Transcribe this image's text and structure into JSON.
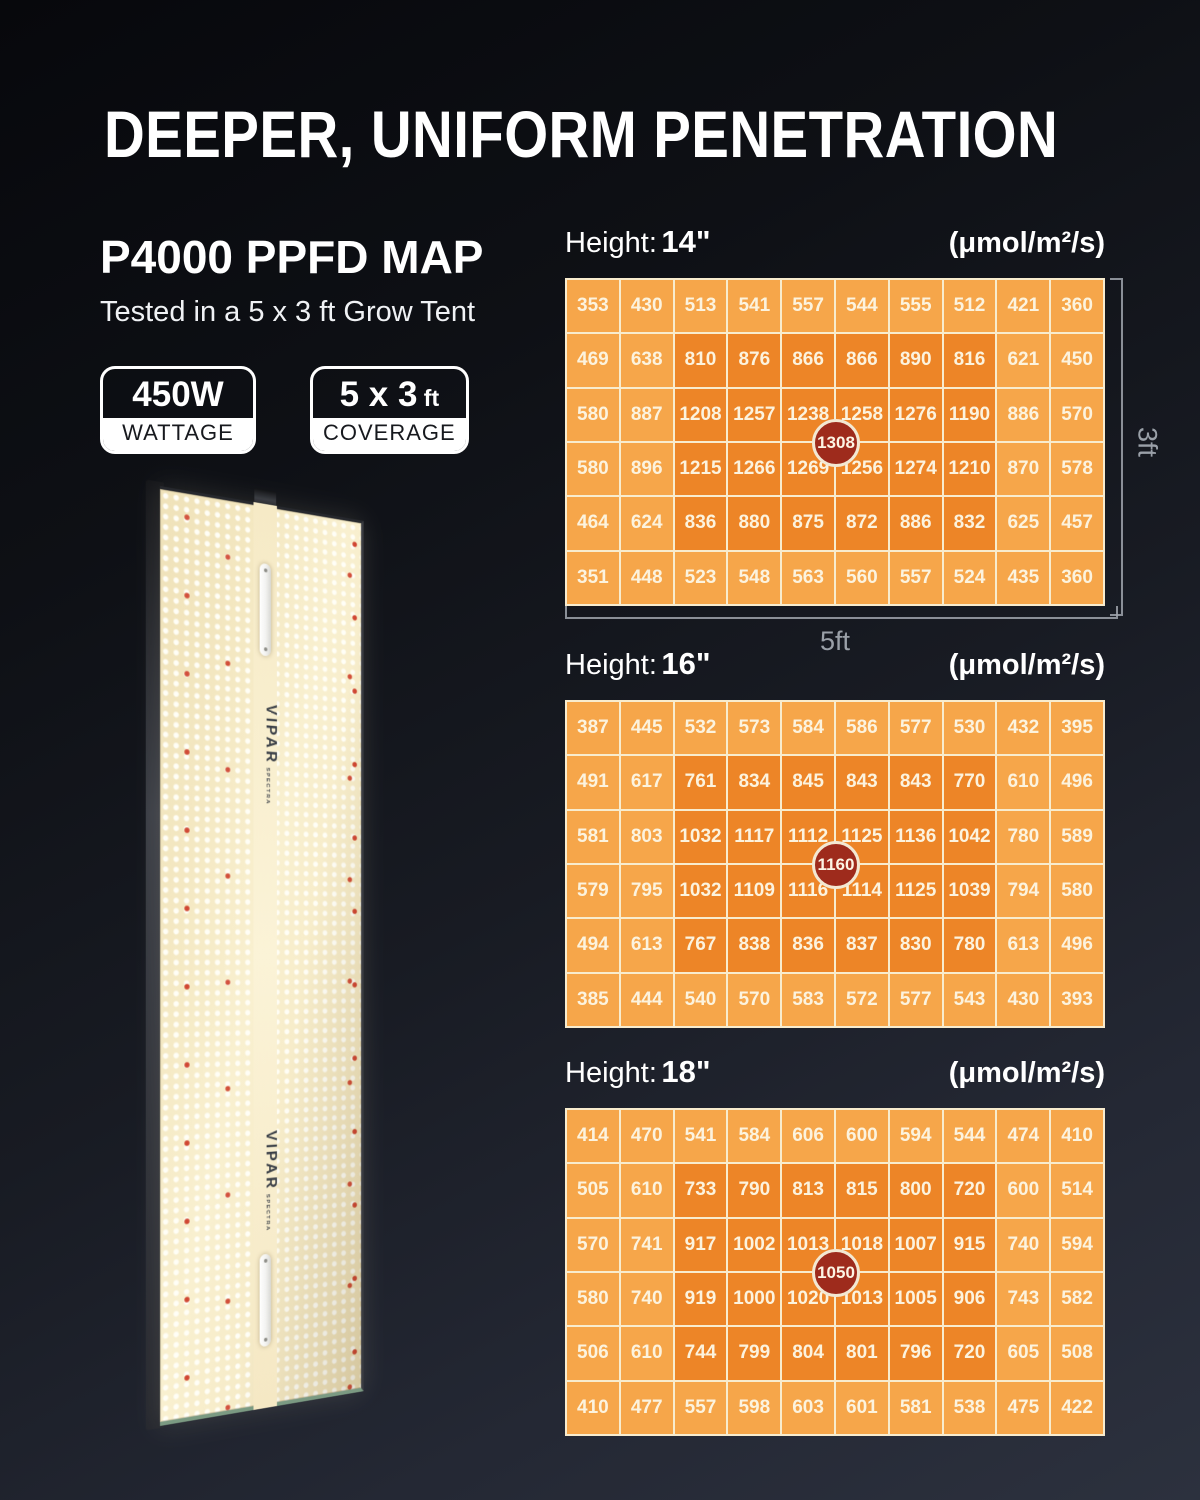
{
  "title": "DEEPER, UNIFORM PENETRATION",
  "intro": {
    "heading": "P4000 PPFD MAP",
    "caption": "Tested in a 5 x 3 ft Grow Tent"
  },
  "badges": [
    {
      "value": "450W",
      "suffix": "",
      "label": "WATTAGE"
    },
    {
      "value": "5 x 3",
      "suffix": " ft",
      "label": "COVERAGE"
    }
  ],
  "panel": {
    "brand": "VIPAR",
    "brand_sub": "SPECTRA"
  },
  "dimensions": {
    "width_label": "5ft",
    "height_label": "3ft"
  },
  "colors": {
    "cell_low": "#f6a64a",
    "cell_high": "#ed8527",
    "peak_bg": "#9e2b1c",
    "grid_line": "#f8ecce",
    "background_top": "#07080c",
    "background_bottom": "#2c313e"
  },
  "chart_data": [
    {
      "type": "heatmap",
      "height_label": "Height:",
      "height_value": "14\"",
      "units": "(μmol/m²/s)",
      "peak_center": 1308,
      "x_extent_label": "5ft",
      "y_extent_label": "3ft",
      "grid": "10 columns x 6 rows",
      "high_zone": "rows 2-5, cols 3-8",
      "rows": [
        [
          353,
          430,
          513,
          541,
          557,
          544,
          555,
          512,
          421,
          360
        ],
        [
          469,
          638,
          810,
          876,
          866,
          866,
          890,
          816,
          621,
          450
        ],
        [
          580,
          887,
          1208,
          1257,
          1238,
          1258,
          1276,
          1190,
          886,
          570
        ],
        [
          580,
          896,
          1215,
          1266,
          1269,
          1256,
          1274,
          1210,
          870,
          578
        ],
        [
          464,
          624,
          836,
          880,
          875,
          872,
          886,
          832,
          625,
          457
        ],
        [
          351,
          448,
          523,
          548,
          563,
          560,
          557,
          524,
          435,
          360
        ]
      ]
    },
    {
      "type": "heatmap",
      "height_label": "Height:",
      "height_value": "16\"",
      "units": "(μmol/m²/s)",
      "peak_center": 1160,
      "grid": "10 columns x 6 rows",
      "high_zone": "rows 2-5, cols 3-8",
      "rows": [
        [
          387,
          445,
          532,
          573,
          584,
          586,
          577,
          530,
          432,
          395
        ],
        [
          491,
          617,
          761,
          834,
          845,
          843,
          843,
          770,
          610,
          496
        ],
        [
          581,
          803,
          1032,
          1117,
          1112,
          1125,
          1136,
          1042,
          780,
          589
        ],
        [
          579,
          795,
          1032,
          1109,
          1116,
          1114,
          1125,
          1039,
          794,
          580
        ],
        [
          494,
          613,
          767,
          838,
          836,
          837,
          830,
          780,
          613,
          496
        ],
        [
          385,
          444,
          540,
          570,
          583,
          572,
          577,
          543,
          430,
          393
        ]
      ]
    },
    {
      "type": "heatmap",
      "height_label": "Height:",
      "height_value": "18\"",
      "units": "(μmol/m²/s)",
      "peak_center": 1050,
      "grid": "10 columns x 6 rows",
      "high_zone": "rows 2-5, cols 3-8",
      "rows": [
        [
          414,
          470,
          541,
          584,
          606,
          600,
          594,
          544,
          474,
          410
        ],
        [
          505,
          610,
          733,
          790,
          813,
          815,
          800,
          720,
          600,
          514
        ],
        [
          570,
          741,
          917,
          1002,
          1013,
          1018,
          1007,
          915,
          740,
          594
        ],
        [
          580,
          740,
          919,
          1000,
          1020,
          1013,
          1005,
          906,
          743,
          582
        ],
        [
          506,
          610,
          744,
          799,
          804,
          801,
          796,
          720,
          605,
          508
        ],
        [
          410,
          477,
          557,
          598,
          603,
          601,
          581,
          538,
          475,
          422
        ]
      ]
    }
  ]
}
